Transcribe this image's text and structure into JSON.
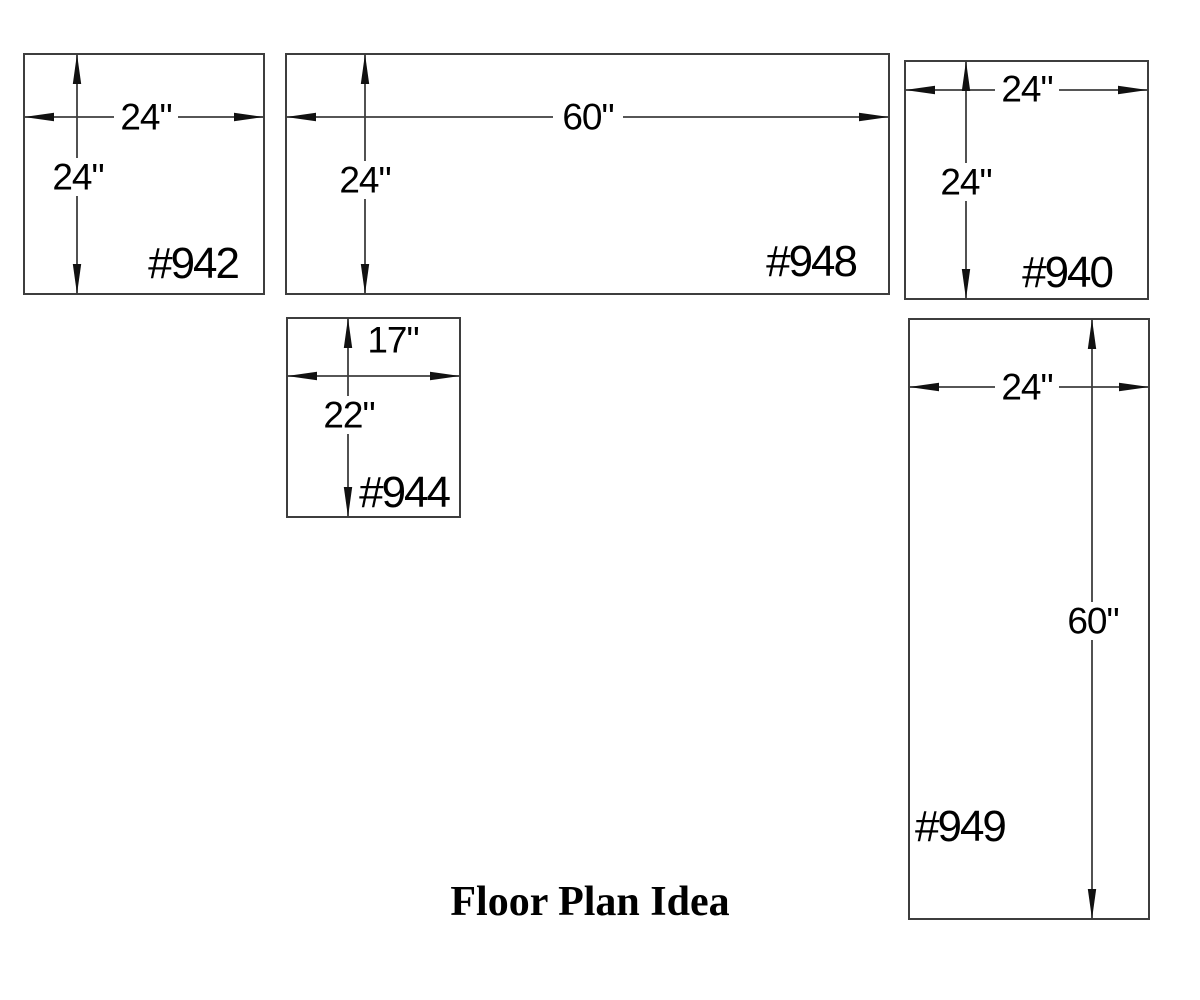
{
  "title": "Floor Plan Idea",
  "pieces": [
    {
      "id": "#942",
      "width": "24\"",
      "height": "24\""
    },
    {
      "id": "#948",
      "width": "60\"",
      "height": "24\""
    },
    {
      "id": "#940",
      "width": "24\"",
      "height": "24\""
    },
    {
      "id": "#944",
      "width": "17\"",
      "height": "22\""
    },
    {
      "id": "#949",
      "width": "24\"",
      "height": "60\""
    }
  ],
  "colors": {
    "background": "#ffffff",
    "line": "#3e3e3e",
    "arrow": "#111111",
    "text": "#000000"
  }
}
